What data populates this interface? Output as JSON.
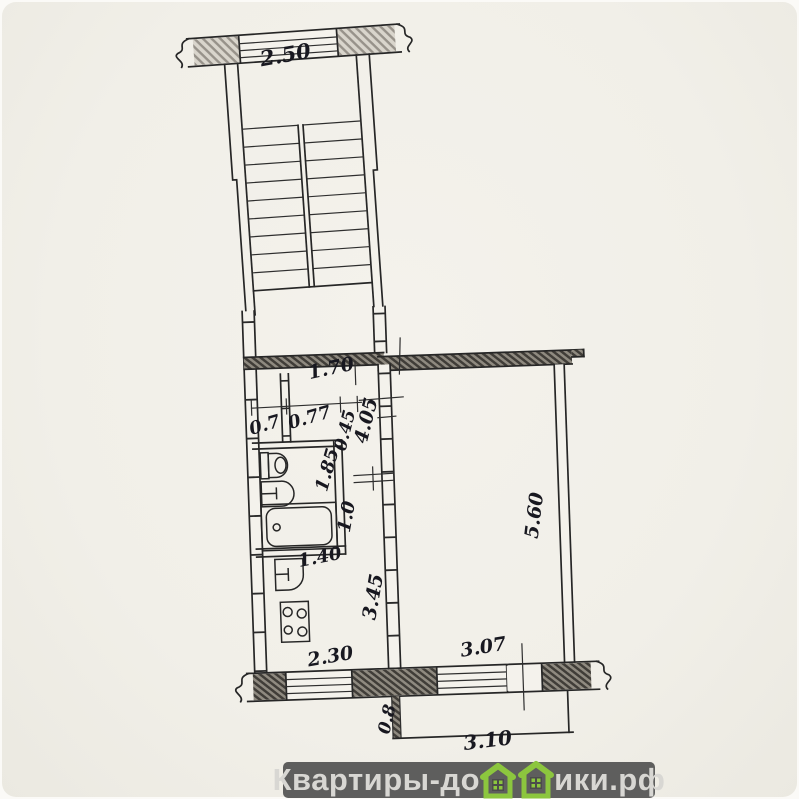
{
  "plan": {
    "type": "apartment-floor-plan-scan",
    "dims": {
      "stair_window": "2.50",
      "hall_width": "1.70",
      "closet_left": "0.7",
      "closet_right": "0.77",
      "wall_nib": "0.45",
      "bathroom_width": "1.85",
      "hall_length": "4.05",
      "corridor_width": "1.0",
      "bathtub_length": "1.40",
      "kitchen_length": "3.45",
      "room_length": "5.60",
      "kitchen_window": "2.30",
      "room_window": "3.07",
      "balcony_depth": "0.8",
      "balcony_width": "3.10"
    }
  },
  "watermark": {
    "text_before_icon": "Квартиры-до",
    "text_after_icon": "ики.рф",
    "icon": "green-houses-icon",
    "bar_color": "#5e5e5d",
    "text_color": "#d8d7d3",
    "house_green": "#8cc63e"
  }
}
